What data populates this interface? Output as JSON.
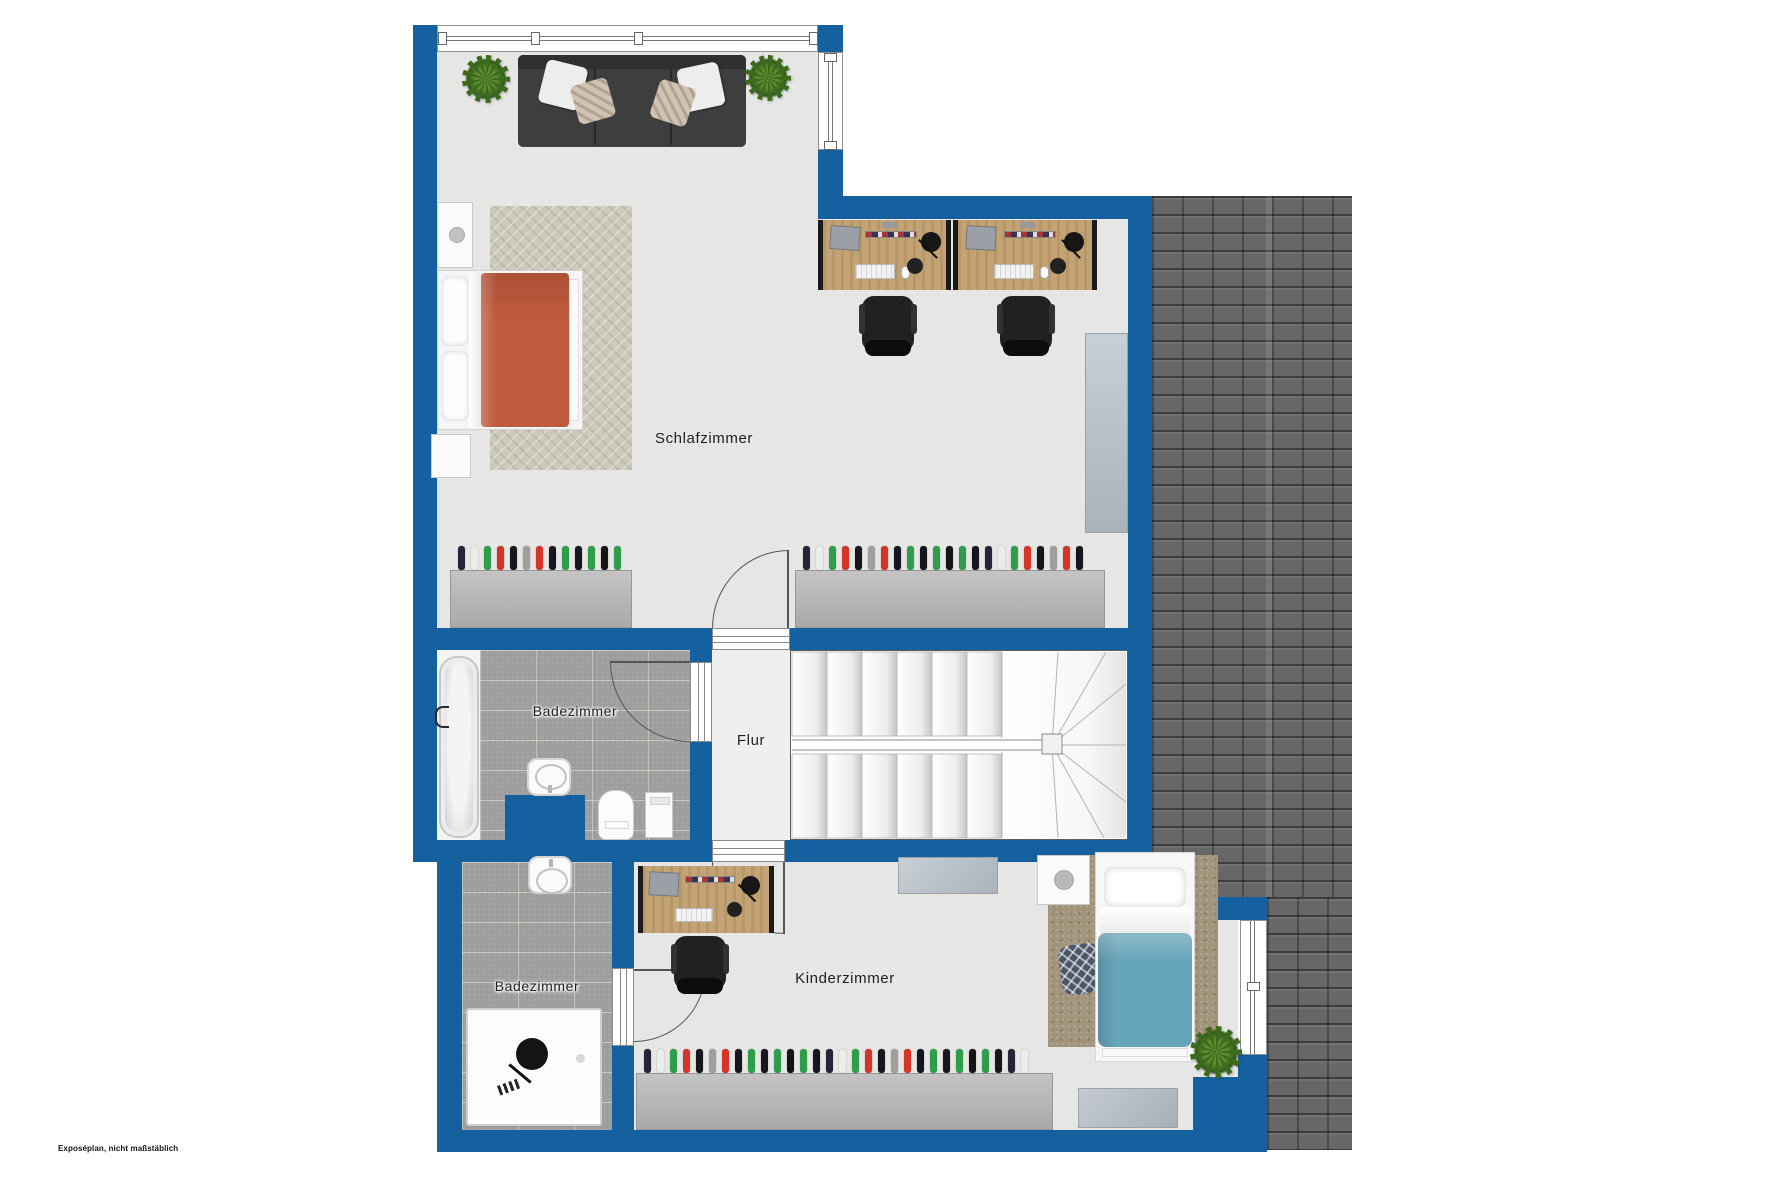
{
  "page": {
    "footnote": "Exposéplan, nicht maßstäblich"
  },
  "colors": {
    "wall": "#15619f",
    "floor": "#e6e6e4",
    "floor_bright": "#efefed",
    "tile": "#9d9d9d",
    "roof": "#676767",
    "wood": "#c3a273",
    "sofa": "#3e3e3e",
    "duvet_orange": "#bf5a3c",
    "duvet_teal": "#66a4b9",
    "rug_beige": "#ccc8ba",
    "rug_brown": "#a2937b",
    "plant": "#3c6b1d",
    "sideboard": "#bcc4cb",
    "door": "#555555"
  },
  "rooms": {
    "schlafzimmer": {
      "label": "Schlafzimmer"
    },
    "badezimmer_top": {
      "label": "Badezimmer"
    },
    "flur": {
      "label": "Flur"
    },
    "badezimmer_bottom": {
      "label": "Badezimmer"
    },
    "kinderzimmer": {
      "label": "Kinderzimmer"
    }
  },
  "wardrobes": {
    "hanger_colors": [
      "#23263a",
      "#ececec",
      "#2f9e4a",
      "#d63329",
      "#15171c",
      "#9f9f9f",
      "#d63329",
      "#15171c",
      "#2f9e4a",
      "#15171c",
      "#2f9e4a",
      "#141414",
      "#2f9e4a",
      "#15171c"
    ],
    "schlafzimmer_left": {
      "hangers": 13
    },
    "schlafzimmer_right": {
      "hangers": 22
    },
    "kinderzimmer": {
      "hangers": 30
    }
  }
}
